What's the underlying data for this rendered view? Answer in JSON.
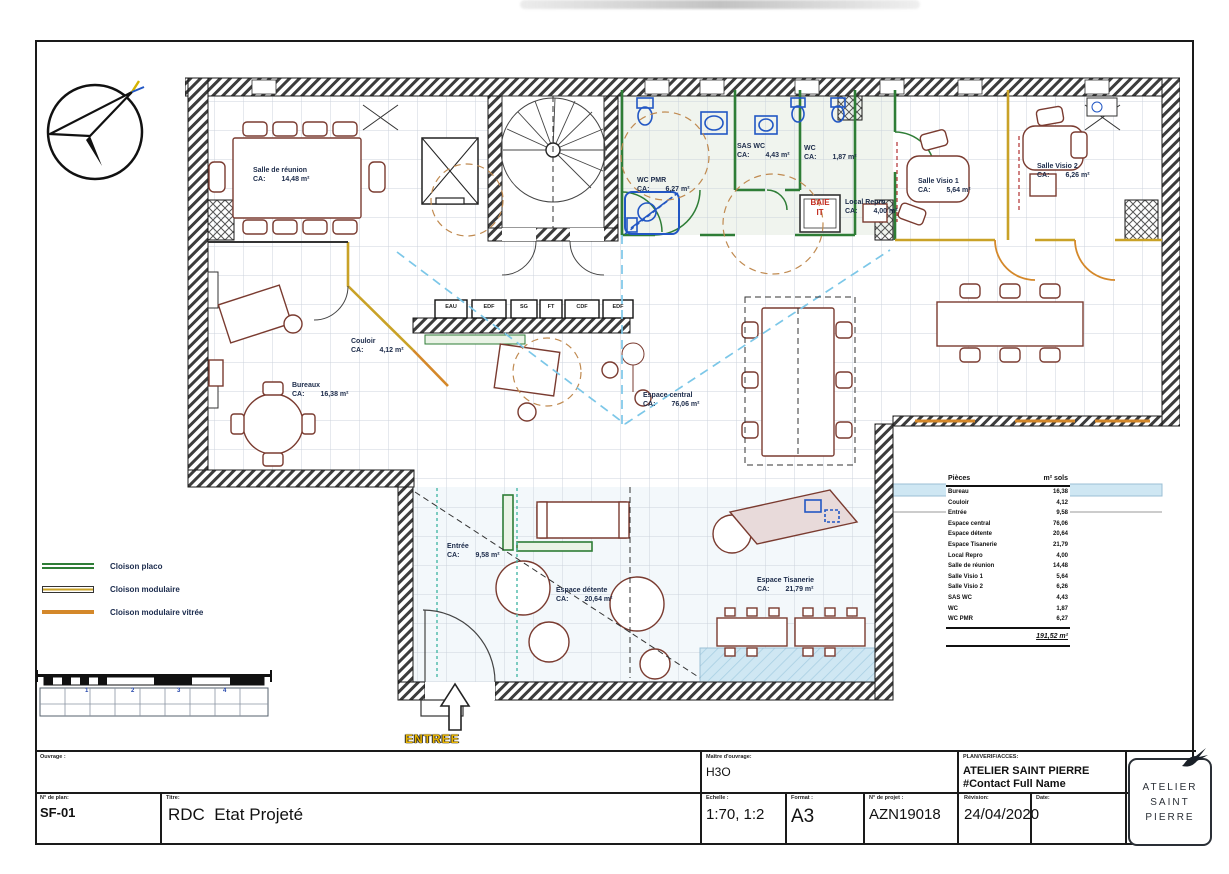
{
  "legend": {
    "items": [
      {
        "label": "Cloison placo"
      },
      {
        "label": "Cloison modulaire"
      },
      {
        "label": "Cloison modulaire vitrée"
      }
    ]
  },
  "scalebar": {
    "ticks": [
      "1",
      "2",
      "3",
      "4"
    ]
  },
  "plan": {
    "ca_label": "CA:",
    "rooms": {
      "salle_reunion": {
        "name": "Salle de réunion",
        "area": "14,48 m²"
      },
      "wc_pmr": {
        "name": "WC PMR",
        "area": "6,27 m²"
      },
      "sas_wc": {
        "name": "SAS WC",
        "area": "4,43 m²"
      },
      "wc": {
        "name": "WC",
        "area": "1,87 m²"
      },
      "local_repro": {
        "name": "Local Repro",
        "area": "4,00 m²"
      },
      "salle_visio1": {
        "name": "Salle Visio 1",
        "area": "5,64 m²"
      },
      "salle_visio2": {
        "name": "Salle Visio 2",
        "area": "6,26 m²"
      },
      "couloir": {
        "name": "Couloir",
        "area": "4,12 m²"
      },
      "bureaux": {
        "name": "Bureaux",
        "area": "16,38 m²"
      },
      "espace_central": {
        "name": "Espace central",
        "area": "76,06 m²"
      },
      "entree": {
        "name": "Entrée",
        "area": "9,58 m²"
      },
      "espace_detente": {
        "name": "Espace détente",
        "area": "20,64 m²"
      },
      "espace_tisanerie": {
        "name": "Espace Tisanerie",
        "area": "21,79 m²"
      }
    },
    "utility_boxes": [
      "EAU",
      "EDF",
      "SG",
      "FT",
      "CDF",
      "EDF"
    ],
    "baie": {
      "line1": "BAIE",
      "line2": "IT"
    },
    "entrance_label": "ENTREE"
  },
  "area_table": {
    "col1": "Pièces",
    "col2": "m² sols",
    "rows": [
      {
        "label": "Bureau",
        "value": "16,38"
      },
      {
        "label": "Couloir",
        "value": "4,12"
      },
      {
        "label": "Entrée",
        "value": "9,58"
      },
      {
        "label": "Espace central",
        "value": "76,06"
      },
      {
        "label": "Espace détente",
        "value": "20,64"
      },
      {
        "label": "Espace Tisanerie",
        "value": "21,79"
      },
      {
        "label": "Local Repro",
        "value": "4,00"
      },
      {
        "label": "Salle de réunion",
        "value": "14,48"
      },
      {
        "label": "Salle Visio 1",
        "value": "5,64"
      },
      {
        "label": "Salle Visio 2",
        "value": "6,26"
      },
      {
        "label": "SAS WC",
        "value": "4,43"
      },
      {
        "label": "WC",
        "value": "1,87"
      },
      {
        "label": "WC PMR",
        "value": "6,27"
      }
    ],
    "total": "191,52 m²"
  },
  "titleblock": {
    "ouvrage_label": "Ouvrage :",
    "plan_no_label": "N° de plan:",
    "plan_no": "SF-01",
    "titre_label": "Titre:",
    "titre": "RDC  Etat Projeté",
    "moa_label": "Maître d'ouvrage:",
    "moa": "H3O",
    "author_label": "PLAN/VERIF/ACCES:",
    "author_line1": "ATELIER SAINT PIERRE",
    "author_line2": "#Contact Full Name",
    "echelle_label": "Echelle :",
    "echelle": "1:70, 1:2",
    "format_label": "Format :",
    "format": "A3",
    "projet_label": "N° de projet :",
    "projet": "AZN19018",
    "revision_label": "Révision:",
    "revision": "24/04/2020",
    "date_label": "Date:",
    "logo": {
      "line1": "ATELIER",
      "line2": "SAINT",
      "line3": "PIERRE"
    }
  },
  "colors": {
    "cloison_placo": "#2e7d36",
    "cloison_modulaire": "#c9a227",
    "cloison_modulaire_vitree": "#d4882a",
    "furniture": "#7a3b30",
    "fixtures_blue": "#2257c4",
    "duct_blue": "#7cc7e8",
    "label_navy": "#1c2b4a"
  }
}
